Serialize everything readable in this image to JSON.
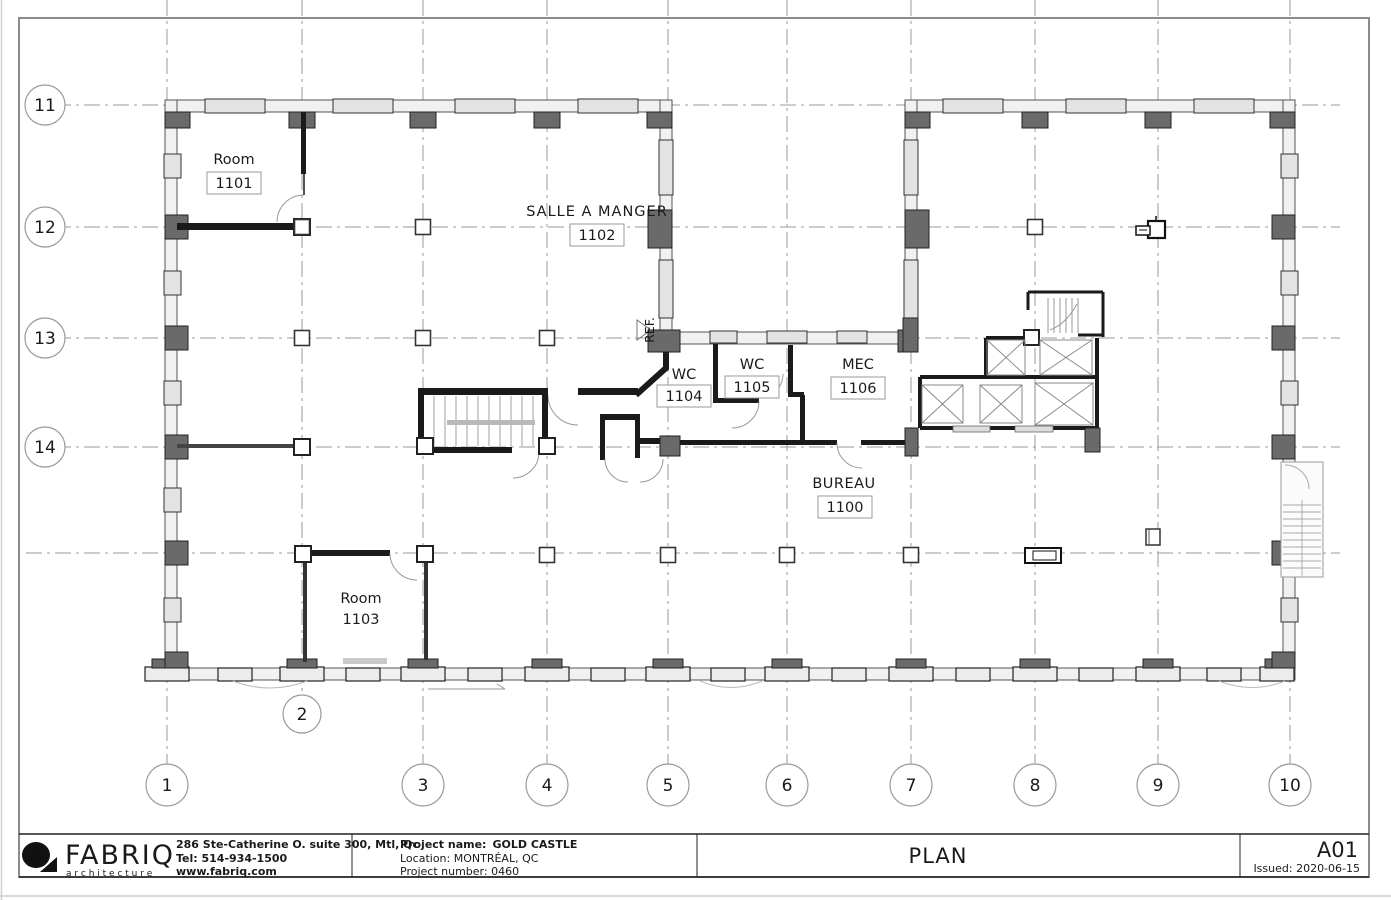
{
  "sheet": {
    "title": "PLAN",
    "number": "A01",
    "issued": "Issued: 2020-06-15"
  },
  "firm": {
    "name": "FABRIQ",
    "tagline": "a r c h i t e c t u r e",
    "address": "286 Ste-Catherine O. suite 300, Mtl, Qc",
    "tel": "Tel: 514-934-1500",
    "web": "www.fabriq.com"
  },
  "project": {
    "name_label": "Project name:",
    "name": "GOLD CASTLE",
    "location": "Location: MONTRÉAL, QC",
    "number": "Project number: 0460"
  },
  "rooms": {
    "room1101": {
      "name": "Room",
      "number": "1101"
    },
    "salle": {
      "name": "SALLE A MANGER",
      "number": "1102"
    },
    "wc1104": {
      "name": "WC",
      "number": "1104"
    },
    "wc1105": {
      "name": "WC",
      "number": "1105"
    },
    "mec": {
      "name": "MEC",
      "number": "1106"
    },
    "bureau": {
      "name": "BUREAU",
      "number": "1100"
    },
    "room1103": {
      "name": "Room",
      "number": "1103"
    },
    "ref": {
      "name": "REF."
    }
  },
  "grid": {
    "cols": [
      "1",
      "2",
      "3",
      "4",
      "5",
      "6",
      "7",
      "8",
      "9",
      "10"
    ],
    "rows": [
      "11",
      "12",
      "13",
      "14"
    ]
  },
  "colors": {
    "wall_fill": "#f1f1f1",
    "column_dark": "#6a6a6a",
    "grid_line": "#9a9a9a",
    "ink": "#1a1a1a"
  }
}
